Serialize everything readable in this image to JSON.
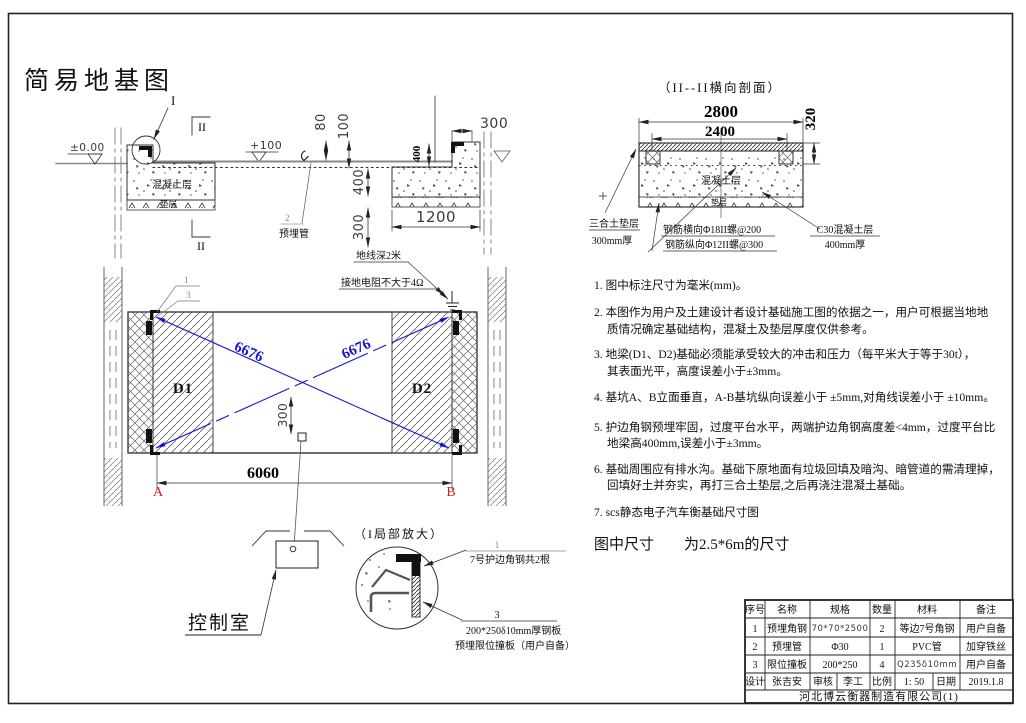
{
  "title": "简易地基图",
  "colors": {
    "accent_blue": "#1515cc",
    "accent_red": "#cc2222",
    "line": "#222222"
  },
  "cross_section": {
    "detail_ref": "I",
    "section_ref": "II",
    "level_zero": "±0.00",
    "level_plus": "+100",
    "concrete_label": "混凝土层",
    "cushion_label": "垫层",
    "pipe_ref": "2",
    "pipe_label": "预埋管",
    "ground_wire": "地线深2米",
    "dims": {
      "d80": "80",
      "d100": "100",
      "d400_top": "400",
      "d300_right": "300",
      "d400_left": "400",
      "d300_left": "300",
      "d1200": "1200"
    }
  },
  "section2": {
    "title": "（II--II横向剖面）",
    "concrete_label": "混凝土层",
    "cushion_label": "垫层",
    "dims": {
      "d2800": "2800",
      "d2400": "2400",
      "d320": "320"
    },
    "callouts": {
      "lime": "三合土垫层",
      "lime2": "300mm厚",
      "rebar1": "钢筋横向Φ18II螺@200",
      "rebar2": "钢筋纵向Φ12II螺@300",
      "c30": "C30混凝土层",
      "c30_2": "400mm厚"
    }
  },
  "plan": {
    "ground_wire": "地线深2米",
    "resistance": "接地电阻不大于4Ω",
    "callout1": "1",
    "callout3": "3",
    "d1": "D1",
    "d2": "D2",
    "diag1": "6676",
    "diag2": "6676",
    "dim300": "300",
    "dim6060": "6060",
    "a": "A",
    "b": "B"
  },
  "control_room": {
    "label": "控制室"
  },
  "detail": {
    "title": "（I局部放大）",
    "callout1": "1",
    "label1": "7号护边角钢共2根",
    "callout3": "3",
    "label3a": "200*250δ10mm厚钢板",
    "label3b": "预埋限位撞板（用户自备）"
  },
  "notes": {
    "n1": "1. 图中标注尺寸为毫米(mm)。",
    "n2a": "2. 本图作为用户及土建设计者设计基础施工图的依据之一，用户可根据当地地",
    "n2b": "质情况确定基础结构，混凝土及垫层厚度仅供参考。",
    "n3a": "3. 地梁(D1、D2)基础必须能承受较大的冲击和压力（每平米大于等于30t），",
    "n3b": "其表面光平，高度误差小于±3mm。",
    "n4": "4. 基坑A、B立面垂直，A-B基坑纵向误差小于 ±5mm,对角线误差小于 ±10mm。",
    "n5a": "5. 护边角钢预埋牢固，过度平台水平，两端护边角钢高度差<4mm，过度平台比",
    "n5b": "地梁高400mm,误差小于±3mm。",
    "n6a": "6. 基础周围应有排水沟。基础下原地面有垃圾回填及暗沟、暗管道的需清理掉，",
    "n6b": "回填好土并夯实，再打三合土垫层,之后再浇注混凝土基础。",
    "n7": "7. scs静态电子汽车衡基础尺寸图",
    "footer": "图中尺寸　　为2.5*6m的尺寸"
  },
  "table": {
    "headers": [
      "序号",
      "名称",
      "规格",
      "数量",
      "材料",
      "备注"
    ],
    "rows": [
      [
        "1",
        "预埋角钢",
        "70*70*2500",
        "2",
        "等边7号角钢",
        "用户自备"
      ],
      [
        "2",
        "预埋管",
        "Φ30",
        "1",
        "PVC管",
        "加穿铁丝"
      ],
      [
        "3",
        "限位撞板",
        "200*250",
        "4",
        "Q235δ10mm",
        "用户自备"
      ]
    ],
    "footer": [
      "设计",
      "张吉安",
      "审核",
      "李工",
      "比例",
      "1: 50",
      "日期",
      "2019.1.8"
    ],
    "company": "河北博云衡器制造有限公司(1)"
  }
}
